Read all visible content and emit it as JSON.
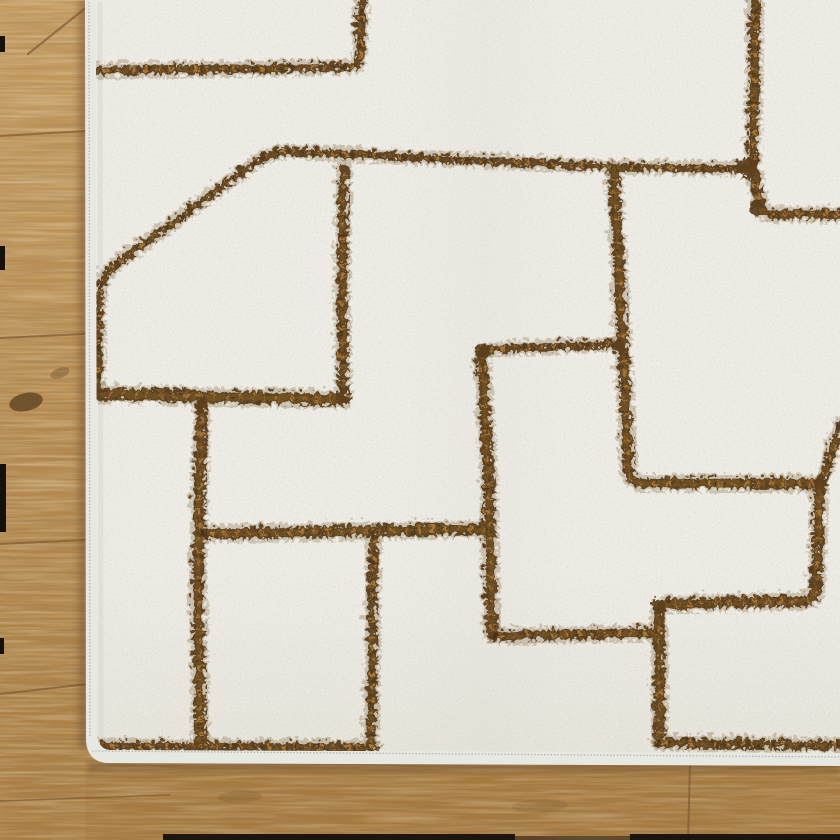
{
  "scene": {
    "description": "Corner of an ivory plush area rug with an abstract brown geometric line pattern, lying on an oak hardwood floor; wood visible along the left side and bottom edge",
    "canvas": {
      "width": 840,
      "height": 840
    }
  },
  "palette": {
    "rug_base": "#f1efe8",
    "rug_base_deep": "#e9e6dc",
    "rug_binding": "#e8e8e3",
    "binding_stitch": "#a9a9a1",
    "pile_edge_shade": "#cfcfc6",
    "line_core": "#5c3f1d",
    "line_halo": "#7a5a2b",
    "line_fleck": "#c08a3e",
    "line_dark": "#3a270f",
    "wood_top": "#c79d61",
    "wood_mid": "#b58a4f",
    "wood_deep": "#a87c41",
    "wood_overlay_bottom": "#9c7038",
    "wood_seam": "#7d5a33",
    "wood_knot": "#5f4424",
    "rug_shadow": "#5e452a",
    "edge_black": "#15100a"
  },
  "rug": {
    "pile_d": "M 96 0 L 840 0 L 840 753 L 110 750 Q 99 749 97 736 Z",
    "binding_d": "M 85 0 L 840 0 L 840 766 L 106 763 Q 87 761 86 740 Z",
    "left_stitch_d": "M 89 2 L 90 738",
    "bottom_stitch_d": "M 92 751 L 840 757",
    "left_pile_shade_d": "M 100 2 L 101 742"
  },
  "pattern_lines": [
    {
      "id": "top-left-horizontal",
      "d": "M 94 68 L 348 64 Q 356 63 357 54 L 359 0",
      "w": 9
    },
    {
      "id": "left-block-curve",
      "d": "M 95 390 L 96 302 Q 96 274 114 261 L 256 157 Q 271 147 292 149 L 610 164 L 742 166",
      "w": 8
    },
    {
      "id": "left-block-bottom",
      "d": "M 94 391 L 340 397",
      "w": 12
    },
    {
      "id": "mid-vertical",
      "d": "M 341 166 L 339 300 L 341 393",
      "w": 10
    },
    {
      "id": "left-vertical",
      "d": "M 199 399 L 195 570 L 198 741",
      "w": 11
    },
    {
      "id": "mid-horizontal",
      "d": "M 200 531 L 486 526",
      "w": 11
    },
    {
      "id": "lower-mid-vertical",
      "d": "M 371 528 L 368 740",
      "w": 9
    },
    {
      "id": "center-vertical",
      "d": "M 479 350 L 486 480 L 489 631",
      "w": 11
    },
    {
      "id": "center-horizontal",
      "d": "M 480 347 L 613 341",
      "w": 8
    },
    {
      "id": "right-vertical-hook",
      "d": "M 611 167 L 620 340 L 626 468 Q 628 480 640 480 L 816 481",
      "w": 11
    },
    {
      "id": "right-diagonal",
      "d": "M 838 420 L 820 476",
      "w": 9
    },
    {
      "id": "right-lower-hook",
      "d": "M 817 481 L 813 586 Q 812 598 800 598 L 666 601 Q 656 602 656 613 L 657 737",
      "w": 11
    },
    {
      "id": "bottom-right-horizontal",
      "d": "M 656 740 L 840 743",
      "w": 9
    },
    {
      "id": "lower-center-horizontal",
      "d": "M 491 633 L 652 630",
      "w": 10
    },
    {
      "id": "top-right-hook",
      "d": "M 752 0 L 750 158 L 757 202 Q 759 211 768 211 L 840 212",
      "w": 10
    },
    {
      "id": "bottom-left-horizontal",
      "d": "M 96 743 L 372 745",
      "w": 9
    }
  ],
  "junction_blobs": [
    {
      "x": 745,
      "y": 165,
      "r": 11
    },
    {
      "x": 340,
      "y": 394,
      "r": 8
    },
    {
      "x": 479,
      "y": 349,
      "r": 8
    },
    {
      "x": 617,
      "y": 344,
      "r": 7
    },
    {
      "x": 818,
      "y": 479,
      "r": 7
    },
    {
      "x": 199,
      "y": 403,
      "r": 7
    },
    {
      "x": 656,
      "y": 603,
      "r": 7
    },
    {
      "x": 754,
      "y": 205,
      "r": 7
    }
  ],
  "wood": {
    "seams": [
      {
        "d": "M 28 54 L 88 6",
        "w": 2.2
      },
      {
        "d": "M 0 136 L 85 131",
        "w": 2.0
      },
      {
        "d": "M 0 338 L 85 334",
        "w": 2.0
      },
      {
        "d": "M 0 544 L 85 540",
        "w": 2.0
      },
      {
        "d": "M 0 694 L 97 683",
        "w": 2.0
      },
      {
        "d": "M 690 763 L 688 840",
        "w": 2.0
      },
      {
        "d": "M 0 801 L 170 795",
        "w": 1.5
      }
    ],
    "knots": [
      {
        "cx": 26,
        "cy": 402,
        "rx": 17,
        "ry": 9,
        "rot": -12,
        "o": 0.8
      },
      {
        "cx": 60,
        "cy": 373,
        "rx": 10,
        "ry": 5,
        "rot": -20,
        "o": 0.35
      },
      {
        "cx": 240,
        "cy": 797,
        "rx": 22,
        "ry": 6,
        "rot": -2,
        "o": 0.18
      },
      {
        "cx": 540,
        "cy": 806,
        "rx": 28,
        "ry": 7,
        "rot": -2,
        "o": 0.14
      }
    ],
    "edge_marks": [
      {
        "x": 0,
        "y": 36,
        "w": 5,
        "h": 16
      },
      {
        "x": 0,
        "y": 246,
        "w": 5,
        "h": 24
      },
      {
        "x": 0,
        "y": 464,
        "w": 6,
        "h": 68
      },
      {
        "x": 0,
        "y": 638,
        "w": 4,
        "h": 16
      }
    ],
    "bottom_bars": [
      {
        "x": 163,
        "y": 834,
        "w": 352,
        "h": 6,
        "o": 0.95
      },
      {
        "x": 515,
        "y": 836,
        "w": 115,
        "h": 4,
        "o": 0.5
      },
      {
        "x": 630,
        "y": 834,
        "w": 210,
        "h": 6,
        "o": 0.95
      }
    ]
  }
}
